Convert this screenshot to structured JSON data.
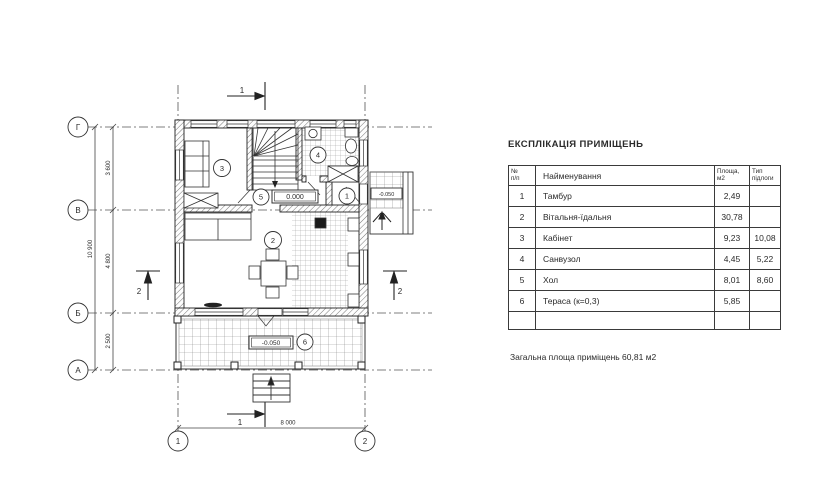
{
  "table": {
    "title": "ЕКСПЛІКАЦІЯ ПРИМІЩЕНЬ",
    "headers": {
      "num_line1": "№",
      "num_line2": "п/п",
      "name": "Найменування",
      "area_line1": "Площа,",
      "area_line2": "м2",
      "floor_line1": "Тип",
      "floor_line2": "підлоги"
    },
    "rows": [
      {
        "num": "1",
        "name": "Тамбур",
        "area": "2,49",
        "floor": ""
      },
      {
        "num": "2",
        "name": "Вітальня-їдальня",
        "area": "30,78",
        "floor": ""
      },
      {
        "num": "3",
        "name": "Кабінет",
        "area": "9,23",
        "floor": "10,08"
      },
      {
        "num": "4",
        "name": "Санвузол",
        "area": "4,45",
        "floor": "5,22"
      },
      {
        "num": "5",
        "name": "Хол",
        "area": "8,01",
        "floor": "8,60"
      },
      {
        "num": "6",
        "name": "Тераса (к=0,3)",
        "area": "5,85",
        "floor": ""
      }
    ],
    "total": "Загальна площа приміщень  60,81 м2"
  },
  "plan": {
    "grid_rows": {
      "g": "Г",
      "v": "В",
      "b": "Б",
      "a": "А"
    },
    "grid_cols": {
      "c1": "1",
      "c2": "2"
    },
    "dims": {
      "total_v": "10 900",
      "seg_gv": "3 600",
      "seg_vb": "4 800",
      "seg_ba": "2 500",
      "total_h": "8 000"
    },
    "sections": {
      "top": "1",
      "bottom": "1",
      "left": "2",
      "right": "2"
    },
    "rooms": {
      "r1": "1",
      "r2": "2",
      "r3": "3",
      "r4": "4",
      "r5": "5",
      "r6": "6"
    },
    "elevations": {
      "hall": "0.000",
      "terrace": "-0.050",
      "porch": "-0.050"
    }
  }
}
